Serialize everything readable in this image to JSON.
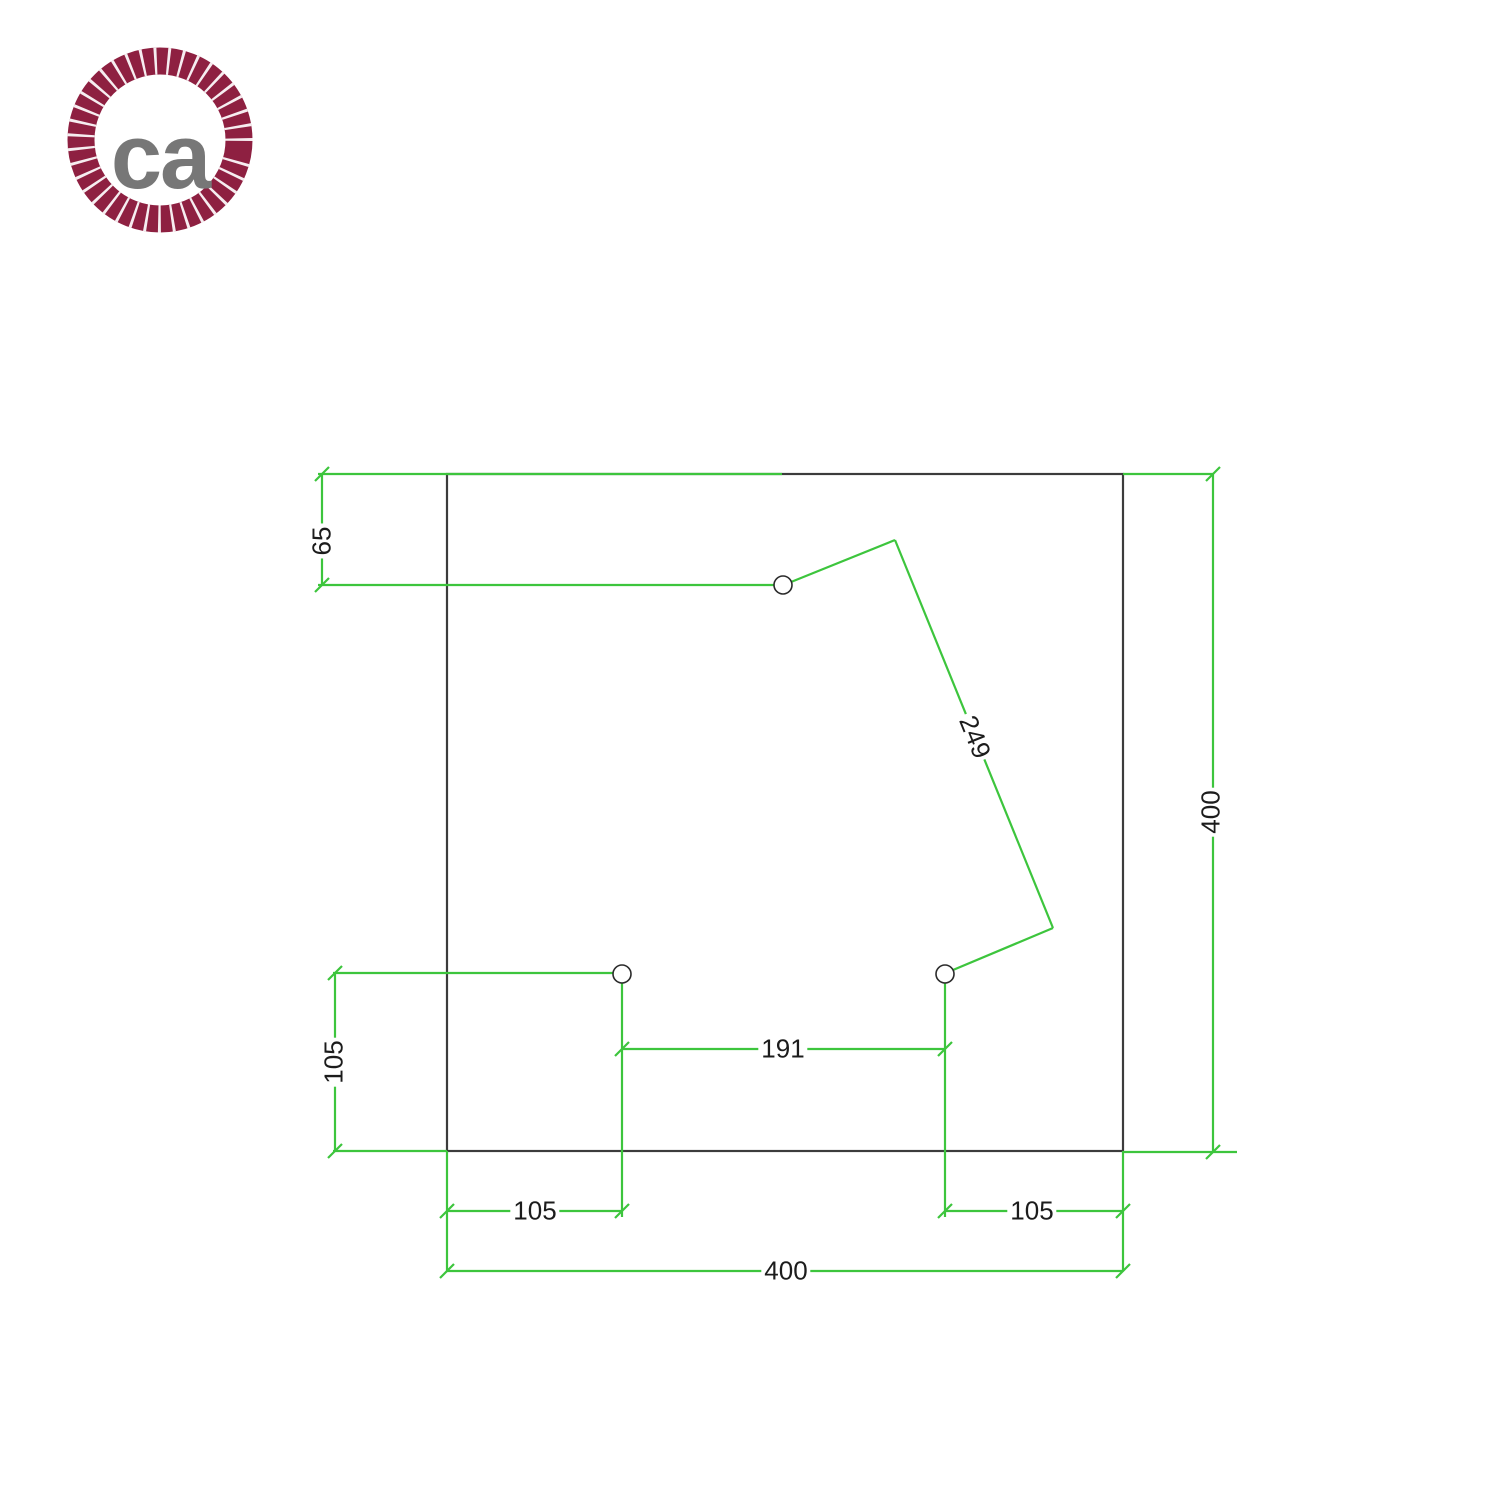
{
  "logo": {
    "text": "ca",
    "ring_color": "#8e2041",
    "ring_gap_color": "#f6edf0",
    "text_color": "#777777"
  },
  "drawing": {
    "plate": {
      "shape": "square",
      "width_mm": "400",
      "height_mm": "400",
      "hole_count": 3
    },
    "colors": {
      "dimension_line": "#3dc53d",
      "plate_outline": "#3c3c3c",
      "hole_outline": "#2b2b2b",
      "dimension_text": "#1c1c1c"
    },
    "dimensions": {
      "hole_top_offset": "65",
      "hole_diagonal_distance": "249",
      "plate_height": "400",
      "hole_left_vertical_offset": "105",
      "holes_horizontal_spacing": "191",
      "hole_bottom_left_offset": "105",
      "hole_bottom_right_offset": "105",
      "plate_width": "400"
    }
  }
}
